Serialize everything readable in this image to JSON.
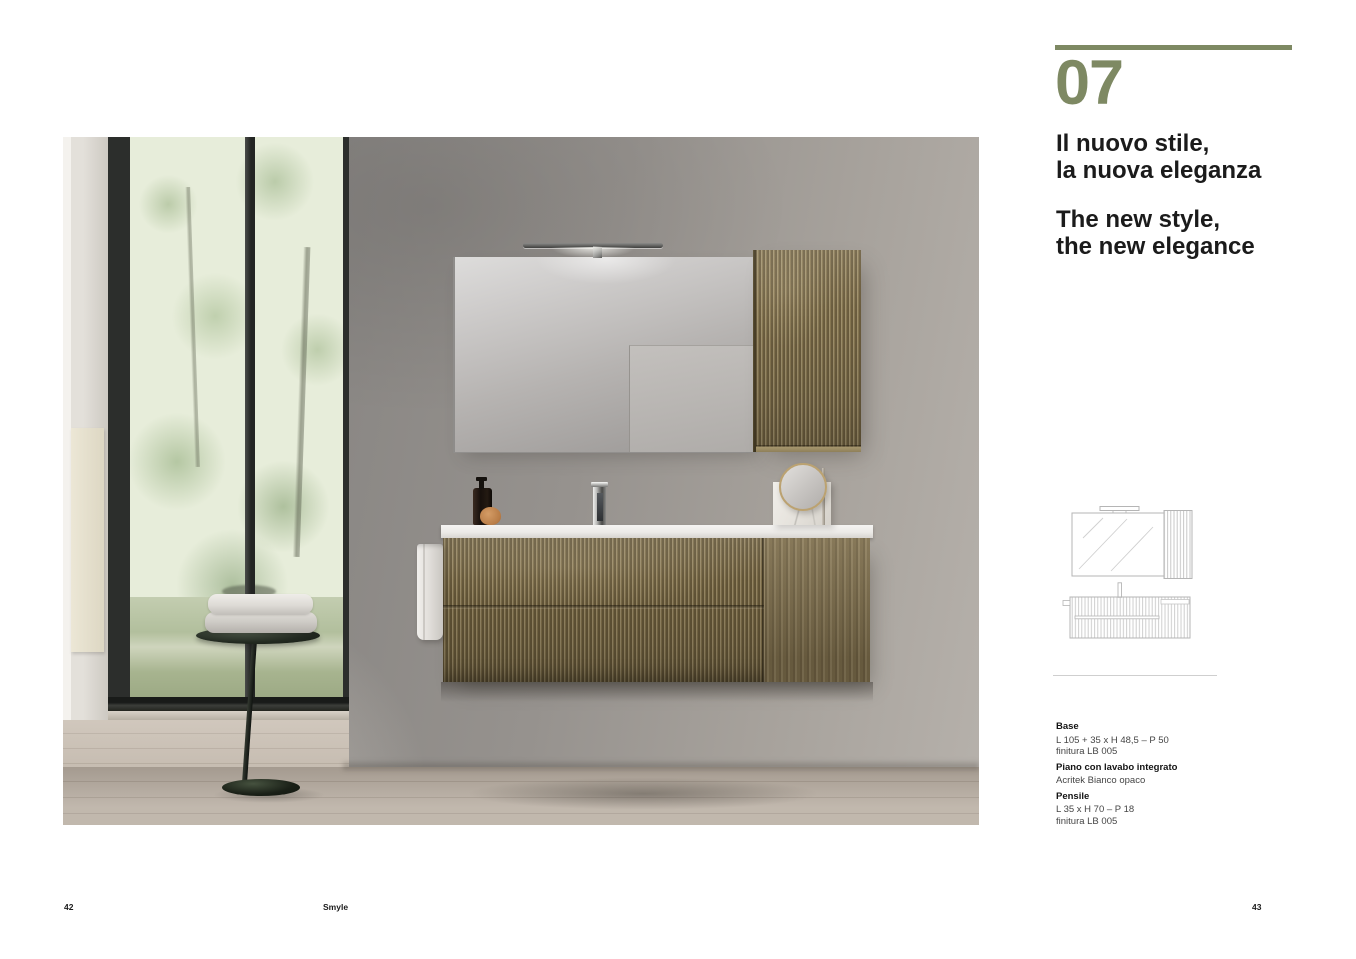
{
  "panel": {
    "accent_color": "#7E8963",
    "section_number": "07",
    "title_it": [
      "Il nuovo stile,",
      "la nuova eleganza"
    ],
    "title_en": [
      "The new style,",
      "the new elegance"
    ],
    "specs": [
      {
        "label": "Base",
        "lines": [
          "L 105 + 35 x H 48,5 – P 50",
          "finitura LB 005"
        ]
      },
      {
        "label": "Piano con lavabo integrato",
        "lines": [
          "Acritek Bianco opaco"
        ]
      },
      {
        "label": "Pensile",
        "lines": [
          "L 35 x H 70 – P 18",
          "finitura LB 005"
        ]
      }
    ]
  },
  "photo_palette": {
    "wood": "#84744F",
    "wall": "#918D89",
    "floor": "#B7ACA0"
  },
  "footer": {
    "left_page_number": "42",
    "brand": "Smyle",
    "right_page_number": "43"
  }
}
